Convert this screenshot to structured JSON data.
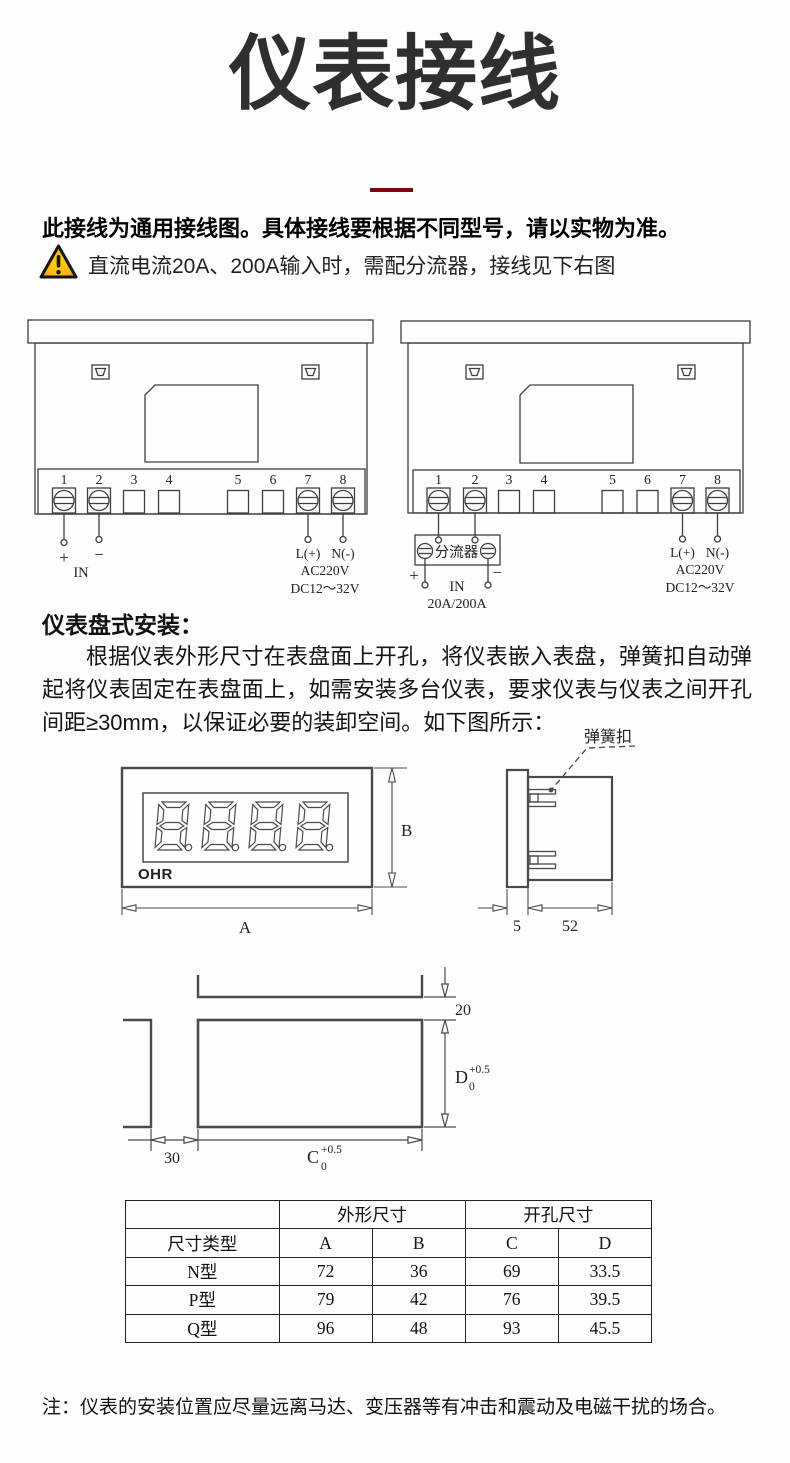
{
  "colors": {
    "accent_red": "#7d070e",
    "warning_fill": "#ffcc00",
    "warning_edge": "#f09000",
    "line": "#3f3f3f"
  },
  "title": "仪表接线",
  "notice_bold": "此接线为通用接线图。具体接线要根据不同型号，请以实物为准。",
  "warning_text": "直流电流20A、200A输入时，需配分流器，接线见下右图",
  "wiring_left": {
    "terminals": [
      "1",
      "2",
      "3",
      "4",
      "5",
      "6",
      "7",
      "8"
    ],
    "plus": "+",
    "minus": "−",
    "in_label": "IN",
    "l_label": "L(+)",
    "n_label": "N(-)",
    "ac_label": "AC220V",
    "dc_label": "DC12～32V"
  },
  "wiring_right": {
    "terminals": [
      "1",
      "2",
      "3",
      "4",
      "5",
      "6",
      "7",
      "8"
    ],
    "shunt_label": "分流器",
    "plus": "+",
    "minus": "−",
    "in_label": "IN",
    "current_label": "20A/200A",
    "l_label": "L(+)",
    "n_label": "N(-)",
    "ac_label": "AC220V",
    "dc_label": "DC12～32V"
  },
  "install": {
    "heading": "仪表盘式安装：",
    "paragraph": "根据仪表外形尺寸在表盘面上开孔，将仪表嵌入表盘，弹簧扣自动弹起将仪表固定在表盘面上，如需安装多台仪表，要求仪表与仪表之间开孔间距≥30mm，以保证必要的装卸空间。如下图所示：",
    "spring_clip_label": "弹簧扣",
    "brand": "OHR",
    "dim_A": "A",
    "dim_B": "B",
    "dim_5": "5",
    "dim_52": "52",
    "dim_20": "20",
    "dim_30": "30",
    "dim_C": {
      "letter": "C",
      "sup": "+0.5",
      "sub": "0"
    },
    "dim_D": {
      "letter": "D",
      "sup": "+0.5",
      "sub": "0"
    }
  },
  "table": {
    "group_outline": "外形尺寸",
    "group_cutout": "开孔尺寸",
    "col_type": "尺寸类型",
    "col_a": "A",
    "col_b": "B",
    "col_c": "C",
    "col_d": "D",
    "rows": [
      {
        "type": "N型",
        "a": "72",
        "b": "36",
        "c": "69",
        "d": "33.5"
      },
      {
        "type": "P型",
        "a": "79",
        "b": "42",
        "c": "76",
        "d": "39.5"
      },
      {
        "type": "Q型",
        "a": "96",
        "b": "48",
        "c": "93",
        "d": "45.5"
      }
    ]
  },
  "note": "注：仪表的安装位置应尽量远离马达、变压器等有冲击和震动及电磁干扰的场合。"
}
